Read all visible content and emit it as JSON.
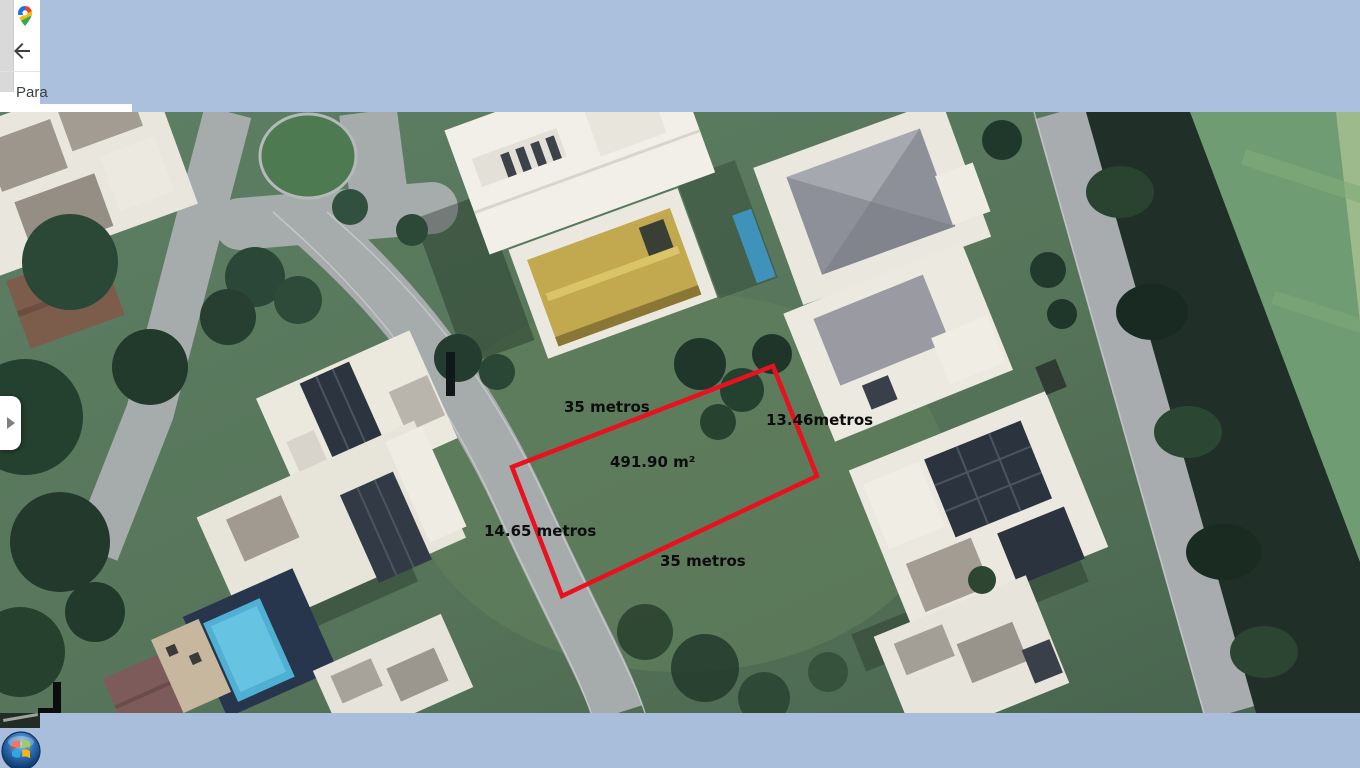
{
  "window": {
    "width_px": 1360,
    "height_px": 768
  },
  "browser_panel": {
    "visible_text": "Para",
    "logo_icon": "google-maps-pin-icon",
    "back_icon": "back-arrow-icon"
  },
  "map": {
    "view": "satellite",
    "panel_toggle_icon": "chevron-right-icon",
    "plot_annotation": {
      "outline_color": "#e9111f",
      "area": "491.90 m²",
      "side_top": "35 metros",
      "side_right": "13.46metros",
      "side_bottom": "35 metros",
      "side_left": "14.65 metros"
    }
  },
  "taskbar": {
    "start_icon": "windows-start-orb-icon"
  },
  "colors": {
    "top_cover_blue": "#abc0dd",
    "taskbar_blue": "#a9bedb",
    "annotation_text": "#0c0c0c"
  }
}
